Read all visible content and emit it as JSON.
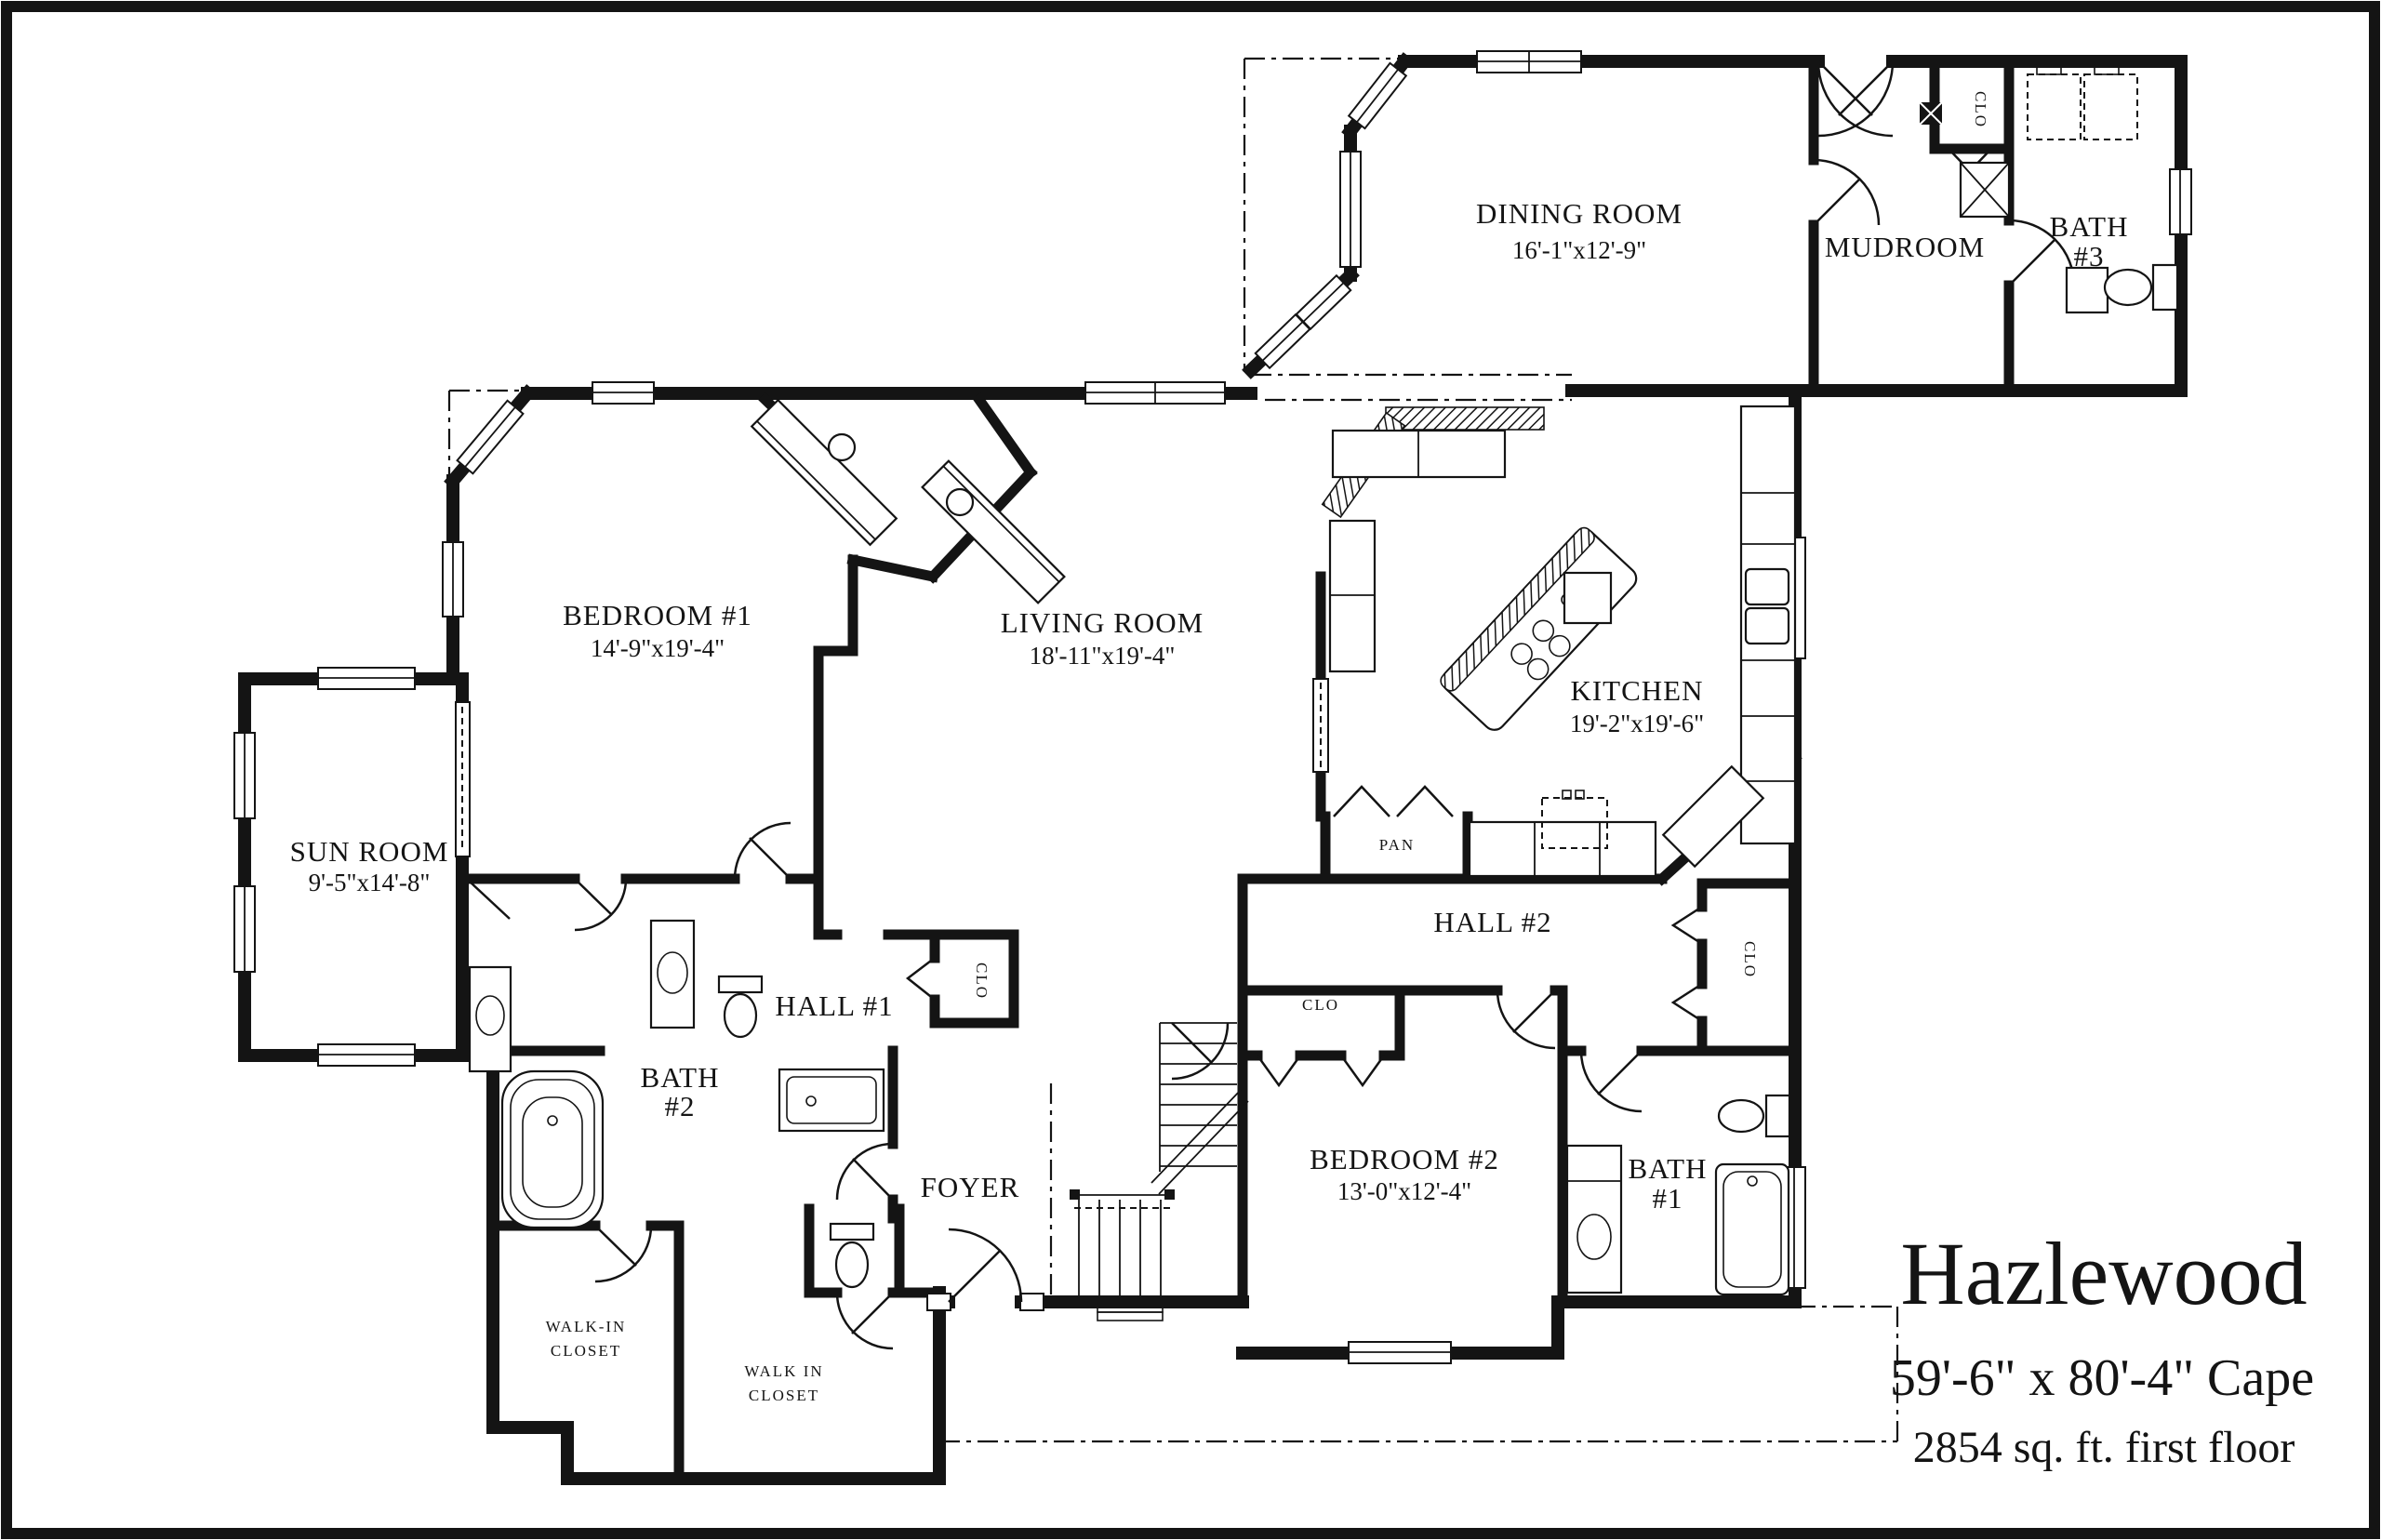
{
  "title": {
    "name": "Hazlewood",
    "size_line": "59'-6\" x 80'-4\" Cape",
    "area_line": "2854 sq. ft. first floor"
  },
  "rooms": {
    "dining": {
      "label": "DINING ROOM",
      "dims": "16'-1\"x12'-9\""
    },
    "mudroom": {
      "label": "MUDROOM"
    },
    "bath3": {
      "label": "BATH",
      "number": "#3"
    },
    "bedroom1": {
      "label": "BEDROOM #1",
      "dims": "14'-9\"x19'-4\""
    },
    "living": {
      "label": "LIVING ROOM",
      "dims": "18'-11\"x19'-4\""
    },
    "kitchen": {
      "label": "KITCHEN",
      "dims": "19'-2\"x19'-6\""
    },
    "sunroom": {
      "label": "SUN ROOM",
      "dims": "9'-5\"x14'-8\""
    },
    "hall1": {
      "label": "HALL #1"
    },
    "hall2": {
      "label": "HALL #2"
    },
    "bath2": {
      "label": "BATH",
      "number": "#2"
    },
    "foyer": {
      "label": "FOYER"
    },
    "bedroom2": {
      "label": "BEDROOM #2",
      "dims": "13'-0\"x12'-4\""
    },
    "bath1": {
      "label": "BATH",
      "number": "#1"
    },
    "walkin1": {
      "line1": "WALK-IN",
      "line2": "CLOSET"
    },
    "walkin2": {
      "line1": "WALK IN",
      "line2": "CLOSET"
    },
    "pantry": {
      "label": "PAN"
    },
    "closet": {
      "label": "CLO"
    }
  },
  "colors": {
    "ink": "#141414",
    "background": "#ffffff"
  }
}
